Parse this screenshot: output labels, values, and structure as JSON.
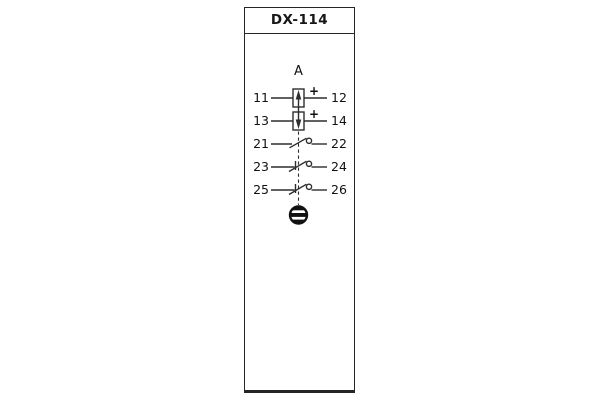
{
  "panel": {
    "title": "DX-114"
  },
  "diagram": {
    "group_label": "A",
    "rows": [
      {
        "left": "11",
        "right": "12",
        "symbol": "coil-arrow-up",
        "polarity": "+"
      },
      {
        "left": "13",
        "right": "14",
        "symbol": "coil-arrow-down",
        "polarity": "+"
      },
      {
        "left": "21",
        "right": "22",
        "symbol": "contact-make"
      },
      {
        "left": "23",
        "right": "24",
        "symbol": "contact-break"
      },
      {
        "left": "25",
        "right": "26",
        "symbol": "contact-break"
      }
    ],
    "bottom_symbol": "ground-screw-terminal"
  },
  "colors": {
    "line": "#2d2d2d",
    "text": "#111111",
    "panel_border": "#262626",
    "background": "#ffffff"
  }
}
